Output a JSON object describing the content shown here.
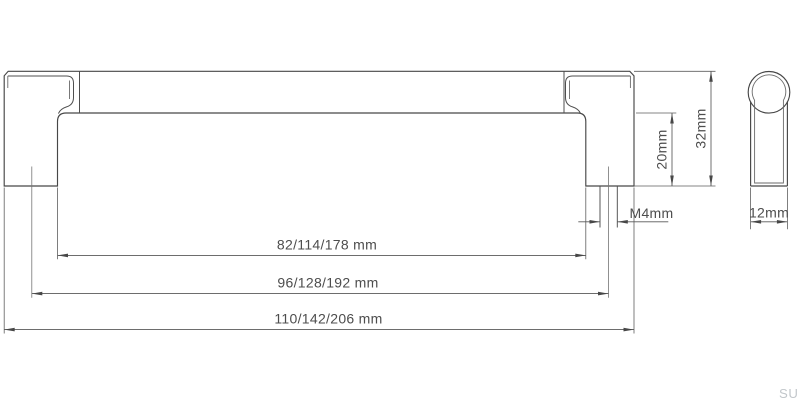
{
  "drawing": {
    "dimensions": {
      "inner_span": "82/114/178 mm",
      "hole_spacing": "96/128/192 mm",
      "overall_length": "110/142/206 mm",
      "drop_height": "20mm",
      "overall_height": "32mm",
      "screw_thread": "M4mm",
      "handle_depth": "12mm"
    },
    "watermark": "SU",
    "colors": {
      "line": "#474747",
      "dimension_line": "#585858",
      "text": "#4d4d4d",
      "watermark": "#c2c7cb",
      "background": "#ffffff"
    }
  }
}
